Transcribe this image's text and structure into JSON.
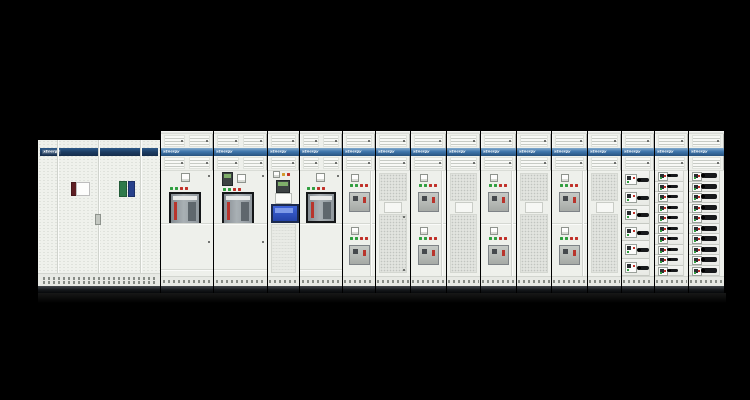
{
  "background_color": "#000000",
  "brand": {
    "label": "xEnergy"
  },
  "colors": {
    "cabinet_body": "#eef0eb",
    "stripe_blue": "#3f76ac",
    "stripe_navy": "#1c3c62",
    "indicator_green": "#2f9e3f",
    "indicator_red": "#c03028",
    "indicator_amber": "#d29a2a",
    "hmi_screen_blue": "#2b50c0",
    "drawer_handle_black": "#17191b",
    "door_tag_maroon": "#5e1f24",
    "door_tag_green": "#2f7a4b",
    "door_tag_blue": "#27408b"
  },
  "lineup": {
    "cabinets": [
      {
        "id": 1,
        "type": "perforated-double-door-cabinet",
        "label": "xEnergy"
      },
      {
        "id": 2,
        "type": "acb-incomer-cabinet",
        "label": "xEnergy"
      },
      {
        "id": 3,
        "type": "acb-incomer-cabinet",
        "label": "xEnergy"
      },
      {
        "id": 4,
        "type": "control-hmi-cabinet",
        "label": "xEnergy"
      },
      {
        "id": 5,
        "type": "acb-incomer-cabinet",
        "label": "xEnergy"
      },
      {
        "id": 6,
        "type": "mccb-feeder-cabinet",
        "label": "xEnergy"
      },
      {
        "id": 7,
        "type": "mesh-door-cabinet",
        "label": "xEnergy"
      },
      {
        "id": 8,
        "type": "mccb-feeder-cabinet",
        "label": "xEnergy"
      },
      {
        "id": 9,
        "type": "mesh-door-cabinet",
        "label": "xEnergy"
      },
      {
        "id": 10,
        "type": "mccb-feeder-cabinet",
        "label": "xEnergy"
      },
      {
        "id": 11,
        "type": "mesh-door-cabinet",
        "label": "xEnergy"
      },
      {
        "id": 12,
        "type": "mccb-feeder-cabinet",
        "label": "xEnergy"
      },
      {
        "id": 13,
        "type": "mesh-door-cabinet",
        "label": "xEnergy"
      },
      {
        "id": 14,
        "type": "withdrawable-module-cabinet",
        "label": "xEnergy",
        "rows": 6
      },
      {
        "id": 15,
        "type": "withdrawable-module-cabinet-dense",
        "label": "xEnergy",
        "rows": 10
      },
      {
        "id": 16,
        "type": "withdrawable-module-cabinet-dense",
        "label": "xEnergy",
        "rows": 10
      }
    ]
  }
}
